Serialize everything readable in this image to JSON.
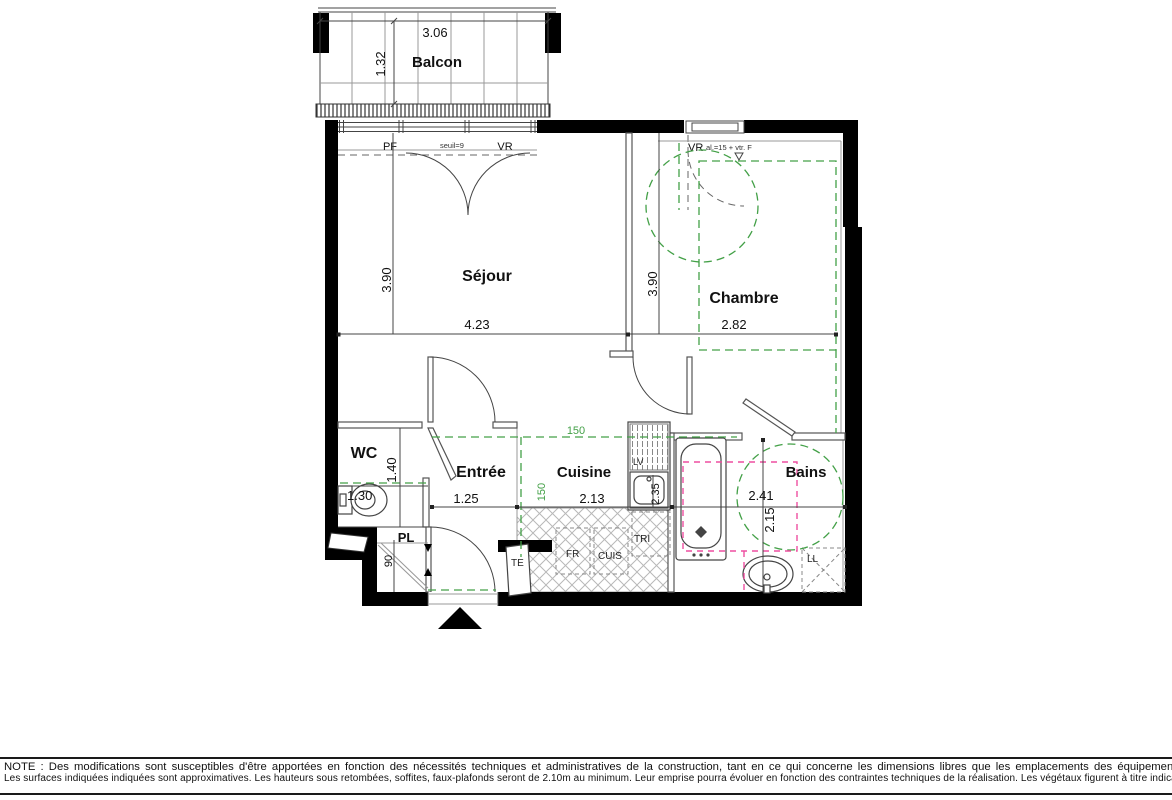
{
  "rooms": {
    "balcon": {
      "name": "Balcon",
      "width": "3.06",
      "depth": "1.32"
    },
    "sejour": {
      "name": "Séjour",
      "width": "4.23",
      "depth": "3.90"
    },
    "chambre": {
      "name": "Chambre",
      "width": "2.82",
      "depth": "3.90"
    },
    "wc": {
      "name": "WC",
      "width": "1.30",
      "depth": "1.40"
    },
    "entree": {
      "name": "Entrée",
      "width": "1.25"
    },
    "cuisine": {
      "name": "Cuisine",
      "width": "2.13",
      "depth": "2.35"
    },
    "bains": {
      "name": "Bains",
      "width": "2.41",
      "depth": "2.15"
    },
    "placard": {
      "name": "PL",
      "depth": "90"
    }
  },
  "clearances": {
    "horizontal": "150",
    "vertical": "150"
  },
  "openings": {
    "pf": "PF",
    "seuil": "seuil=9",
    "vr": "VR",
    "chambre_vr": "VR",
    "chambre_vr_spec": "al.=15 + vtr. F"
  },
  "equipment": {
    "lv": "LV",
    "tri": "TRI",
    "fr": "FR",
    "cuis": "CUIS",
    "te": "TE",
    "ll": "LL"
  },
  "note": {
    "line1": "NOTE :  Des modifications sont susceptibles d'être apportées en fonction des nécessités techniques et administratives de la construction, tant en ce qui concerne les dimensions libres que les emplacements des équipements.",
    "line2": "Les surfaces indiquées indiquées sont approximatives. Les hauteurs sous retombées, soffites, faux-plafonds seront de 2.10m au minimum. Leur emprise pourra évoluer en fonction des contraintes techniques de la réalisation. Les végétaux figurent à titre indicatif."
  },
  "colors": {
    "wall": "#000000",
    "line": "#444444",
    "green": "#43a047",
    "pink": "#ee4fa1"
  }
}
